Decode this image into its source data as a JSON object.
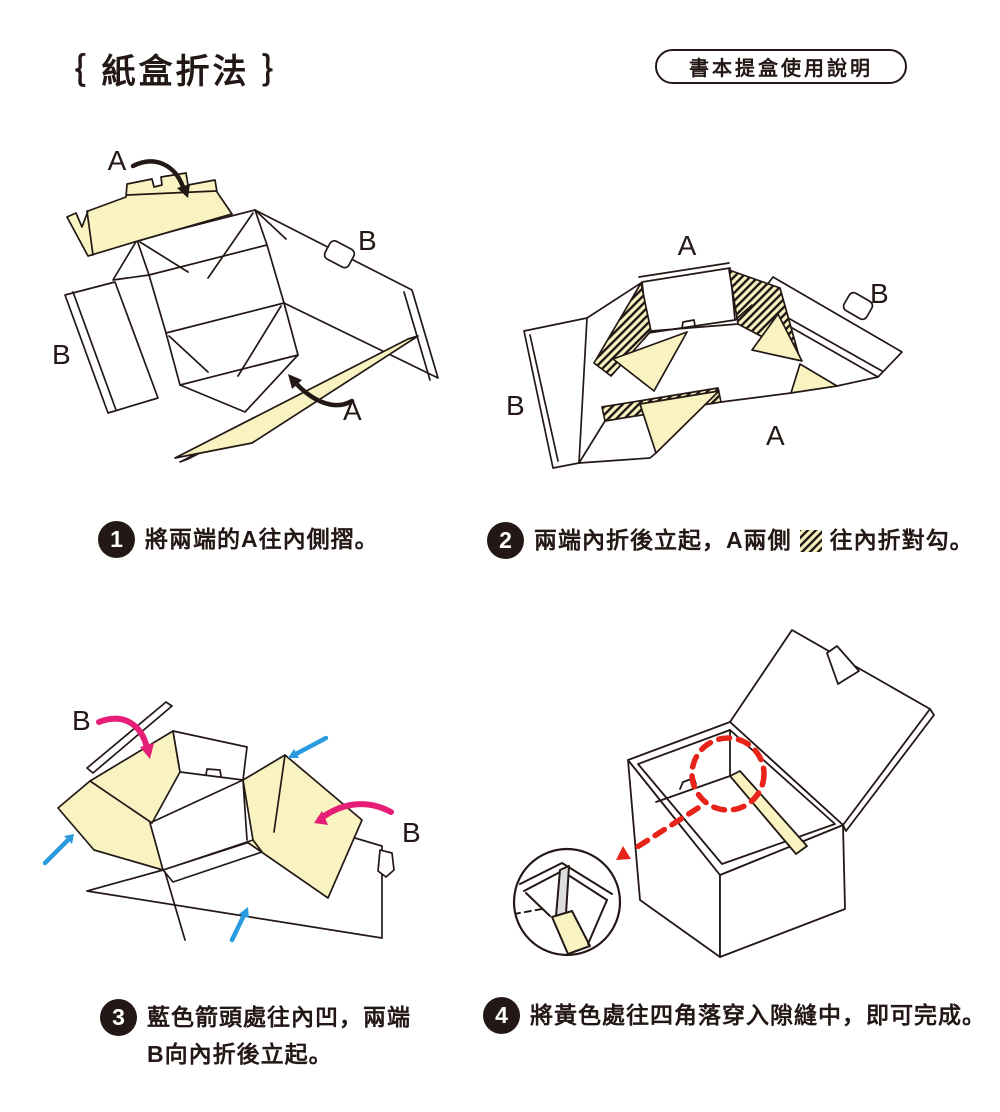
{
  "title": "｛ 紙盒折法 ｝",
  "badge": "書本提盒使用說明",
  "colors": {
    "paper_yellow": "#F8F3C1",
    "outline": "#231815",
    "arrow_pink": "#E61E78",
    "arrow_blue": "#2B9BE0",
    "arrow_red": "#E8231A"
  },
  "steps": [
    {
      "number": "1",
      "text": "將兩端的A往內側摺。"
    },
    {
      "number": "2",
      "text_before": "兩端內折後立起，A兩側",
      "text_after": "往內折對勾。"
    },
    {
      "number": "3",
      "line1": "藍色箭頭處往內凹，兩端",
      "line2": "B向內折後立起。"
    },
    {
      "number": "4",
      "text": "將黃色處往四角落穿入隙縫中，即可完成。"
    }
  ],
  "diagrams": {
    "step1": {
      "label_a_top": "A",
      "label_b_right": "B",
      "label_b_left": "B",
      "label_a_bottom": "A"
    },
    "step2": {
      "label_a_top": "A",
      "label_b_right": "B",
      "label_b_left": "B",
      "label_a_bottom": "A"
    },
    "step3": {
      "label_b_left": "B",
      "label_b_right": "B"
    }
  }
}
